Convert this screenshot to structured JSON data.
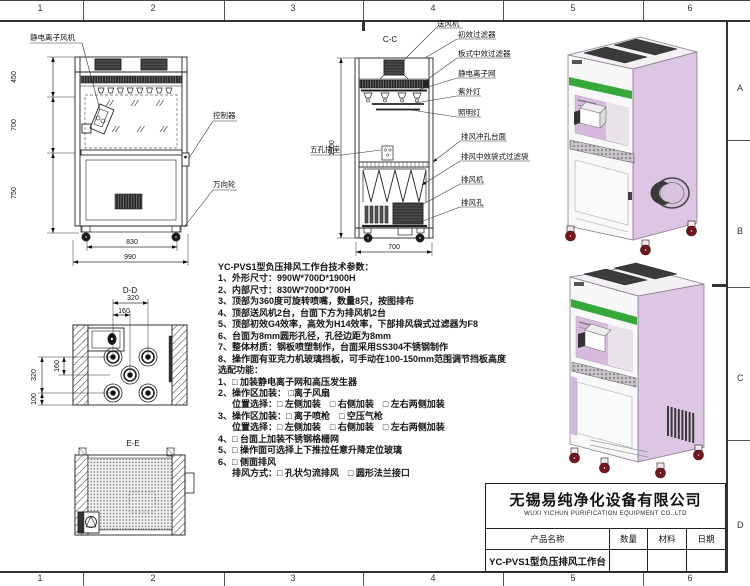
{
  "sheet": {
    "zones_top": [
      "1",
      "2",
      "3",
      "4",
      "5",
      "6"
    ],
    "zones_bottom": [
      "1",
      "2",
      "3",
      "4",
      "5",
      "6"
    ],
    "zones_right": [
      "A",
      "B",
      "C",
      "D"
    ]
  },
  "front_view": {
    "label_ion_fan": "静电离子风机",
    "label_controller": "控制器",
    "label_caster": "万向轮",
    "dim_450": "450",
    "dim_700": "700",
    "dim_750": "750",
    "dim_830": "830",
    "dim_990": "990"
  },
  "section_cc": {
    "title": "C-C",
    "dim_height": "1900",
    "dim_width": "700",
    "label_socket": "五孔插座",
    "labels": [
      "送风机",
      "初效过滤器",
      "板式中效过滤器",
      "静电离子网",
      "紫外灯",
      "照明灯",
      "排风冲孔台面",
      "排风中效袋式过滤袋",
      "排风机",
      "排风孔"
    ]
  },
  "view_dd": {
    "title": "D-D",
    "dim_320_top": "320",
    "dim_160_top": "160",
    "dim_320_left": "320",
    "dim_160_left": "160",
    "dim_100_left": "100"
  },
  "view_ee": {
    "title": "E-E"
  },
  "specs": {
    "lines": [
      "YC-PVS1型负压排风工作台技术参数：",
      "1、外形尺寸：990W*700D*1900H",
      "2、内部尺寸：830W*700D*700H",
      "3、顶部为360度可旋转喷嘴，数量8只，按图排布",
      "4、顶部送风机2台，台面下方为排风机2台",
      "5、顶部初效G4效率，高效为H14效率，下部排风袋式过滤器为F8",
      "6、台面为8mm圆形孔径，孔径边距为8mm",
      "7、整体材质：钢板喷塑制作，台面采用SS304不锈钢制作",
      "8、操作面有亚克力机玻璃挡板，可手动在100-150mm范围调节挡板高度",
      "选配功能：",
      "1、□ 加装静电离子网和高压发生器",
      "2、操作区加装： □离子风扇",
      "位置选择：□ 左侧加装　□ 右侧加装　□ 左右两侧加装",
      "3、操作区加装：□ 离子喷枪　□ 空压气枪",
      "位置选择：□ 左侧加装　□ 右侧加装　□ 左右两侧加装",
      "4、□ 台面上加装不锈钢格栅网",
      "5、□ 操作面可选择上下推拉任意升降定位玻璃",
      "6、□ 侧面排风",
      "排风方式：□ 孔状匀流排风　□ 圆形法兰接口"
    ]
  },
  "title_block": {
    "company_cn": "无锡易纯净化设备有限公司",
    "company_en": "WUXI YICHUN PURIFICATION EQUIPMENT CO.,LTD",
    "headers": [
      "产品名称",
      "数量",
      "材料",
      "日期"
    ],
    "product_name": "YC-PVS1型负压排风工作台"
  },
  "watermark": "易纯净化",
  "colors": {
    "panel_lavender": "#dcc6e3",
    "panel_lavender_dark": "#d3b6dd",
    "stripe_green": "#35a83a",
    "wheel_red": "#7a1520"
  }
}
